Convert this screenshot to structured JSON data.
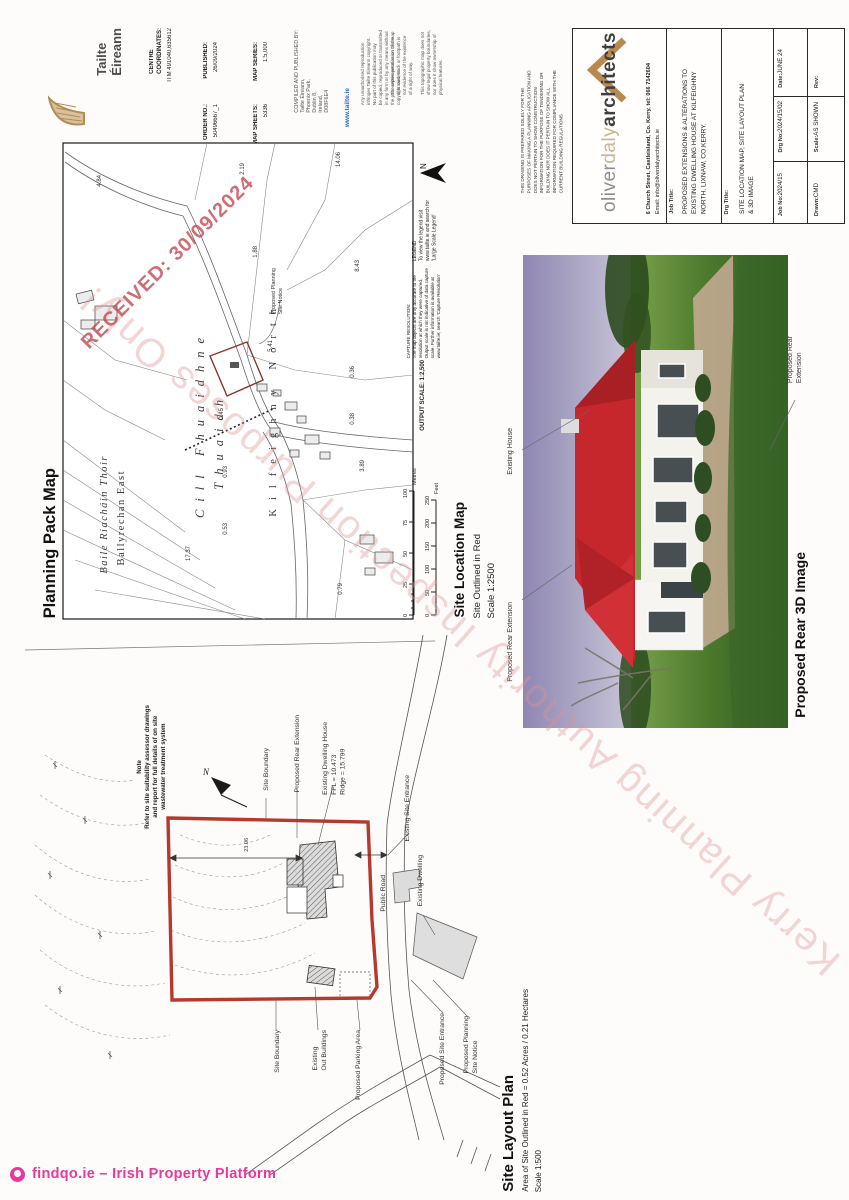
{
  "stamps": {
    "received": "RECEIVED: 30/09/2024",
    "watermark": "Kerry Planning Authority      Inspection Purposes Only!"
  },
  "footer": {
    "brand": "findqo.ie – Irish Property Platform"
  },
  "map_sheet": {
    "title": "Planning Pack Map",
    "publisher": {
      "name": "Tailte\nÉireann"
    },
    "fields": {
      "centre": {
        "label": "CENTRE\nCOORDINATES:",
        "value": "ITM  491040,635612"
      },
      "published": {
        "label": "PUBLISHED:",
        "value": "26/09/2024"
      },
      "order_no": {
        "label": "ORDER NO.:",
        "value": "50496667_1"
      },
      "map_series": {
        "label": "MAP SERIES:",
        "value": "1:5,000"
      },
      "map_sheets": {
        "label": "MAP SHEETS:",
        "value": "5336"
      }
    },
    "compiled_by": "COMPILED AND PUBLISHED BY:\nTailte Éireann,\nPhoenix Park,\nDublin 8,\nIreland,\nD08F6E4",
    "website": "www.tailte.ie",
    "copyright_1": "Any unauthorised reproduction\ninfringes Tailte Éireann copyright.\nNo part of this publication may\nbe copied, reproduced or transmitted\nin any form or by any means without\nthe prior written permission of the\ncopyright owners.",
    "copyright_2": "The representation on this map\nof a road, track or footpath is\nnot evidence of the existence\nof a right of way.\n\nThis topographic map does not\nshow legal property boundaries,\nnor does it show ownership of\nphysical features.",
    "legend": "LEGEND\nTo view the legend visit\nwww.tailte.ie and search for\n'Large Scale Legend'",
    "capture_resolution": "CAPTURE RESOLUTION:\nThe map objects are only accurate to the\nresolution at which they were captured.\nOutput scale is not indicative of data capture\nscale. Further information is available at\nwww.tailte.ie; search 'Capture Resolution'",
    "output_scale": "OUTPUT SCALE: 1:2,500",
    "north": "N",
    "scalebar": {
      "metres": [
        "0",
        "25",
        "50",
        "75",
        "100"
      ],
      "metres_unit": "Metres",
      "feet": [
        "0",
        "50",
        "100",
        "150",
        "200",
        "250"
      ],
      "feet_unit": "Feet"
    },
    "townlands": {
      "irish_1": "Cill Fhuaidhne",
      "irish_2": "Thuaidh",
      "english_1": "Kilfeighny North",
      "irish_3": "Baile Riacháin Thoir",
      "english_3": "Ballyrechan East"
    },
    "site_notice_label": "Proposed Planning\nSite Notice",
    "parcels": [
      "4.84",
      "2.19",
      "14.06",
      "1.88",
      "8.43",
      "5.41",
      "0.36",
      "0.45",
      "0.38",
      "0.93",
      "0.53",
      "3.89",
      "17.37",
      "0.79"
    ],
    "caption": {
      "line1": "Site Location Map",
      "line2": "Site Outlined in Red",
      "line3": "Scale 1:2500"
    }
  },
  "title_block": {
    "disclaimer": "THIS DRAWING IS PREPARED SOLELY FOR THE\nPURPOSES OF MAKING A PLANNING APPLICATION AND\nDOES NOT PERTAIN TO SHOW CONSTRUCTION\nINFORMATION FOR THE PURPOSE OF TENDERING OR\nBUILDING NOR DOES IT PERTAIN TO SHOW ALL\nINFORMATION REQUIRED FOR COMPLIANCE WITH THE\nCURRENT BUILDING REGULATIONS",
    "firm": {
      "part1": "oliver",
      "part2": "daly",
      "part3": "architects"
    },
    "address": "6 Church Street, Castleisland, Co. Kerry, tel: 066 7142604",
    "email": "Email: info@oliverdalyarchitects.ie",
    "job_title": {
      "label": "Job Title:",
      "text": "PROPOSED EXTENSIONS & ALTERATIONS TO\nEXISTING DWELLING HOUSE AT KILFEIGHNY\nNORTH, LIXNAW, CO.KERRY."
    },
    "drg_title": {
      "label": "Drg Title:",
      "text": "SITE LOCATION MAP, SITE LAYOUT PLAN\n& 3D IMAGE"
    },
    "grid": {
      "job_no": {
        "label": "Job No:",
        "value": "2024/15"
      },
      "drg_no": {
        "label": "Drg No:",
        "value": "2024/15/02"
      },
      "date": {
        "label": "Date:",
        "value": "JUNE 24"
      },
      "drawn": {
        "label": "Drawn:",
        "value": "CMD"
      },
      "scale": {
        "label": "Scale:",
        "value": "AS SHOWN"
      },
      "rev": {
        "label": "Rev:",
        "value": ""
      }
    }
  },
  "render_3d": {
    "caption": "Proposed Rear 3D Image",
    "labels": {
      "existing_house": "Existing House",
      "rear_ext_right": "Proposed Rear\nExtension",
      "rear_ext_left": "Proposed Rear Extension"
    },
    "colors": {
      "roof": "#c5272d",
      "sky": "#9f97bd",
      "grass": "#4f7c2e",
      "wall": "#f3f2ed"
    }
  },
  "layout_plan": {
    "note": "Note\nRefer to site suitability assessor drawings\nand report for full details of on site\nwastewater treatment system",
    "labels": [
      "Site Boundary",
      "Proposed Rear Extension",
      "Existing Dwelling House\nFFL = 10.473\nRidge = 15.799",
      "Existing Site Entrance",
      "Public Road",
      "Existing Dwelling",
      "Site Boundary",
      "Existing\nOut Buildings",
      "Proposed Parking Area",
      "Proposed Site Entrance",
      "Proposed Planning\nSite Notice"
    ],
    "north": "N",
    "dimension": "23.06",
    "title": {
      "line1": "Site Layout Plan",
      "line2": "Area of Site Outlined in Red = 0.52 Acres / 0.21 Hectares",
      "line3": "Scale 1:500"
    }
  },
  "colors": {
    "watermark": "#de9292",
    "stamp": "#c4494f",
    "site_outline": "#b5392c",
    "brand_pink": "#e6399b",
    "logo_tan": "#b98a50"
  }
}
